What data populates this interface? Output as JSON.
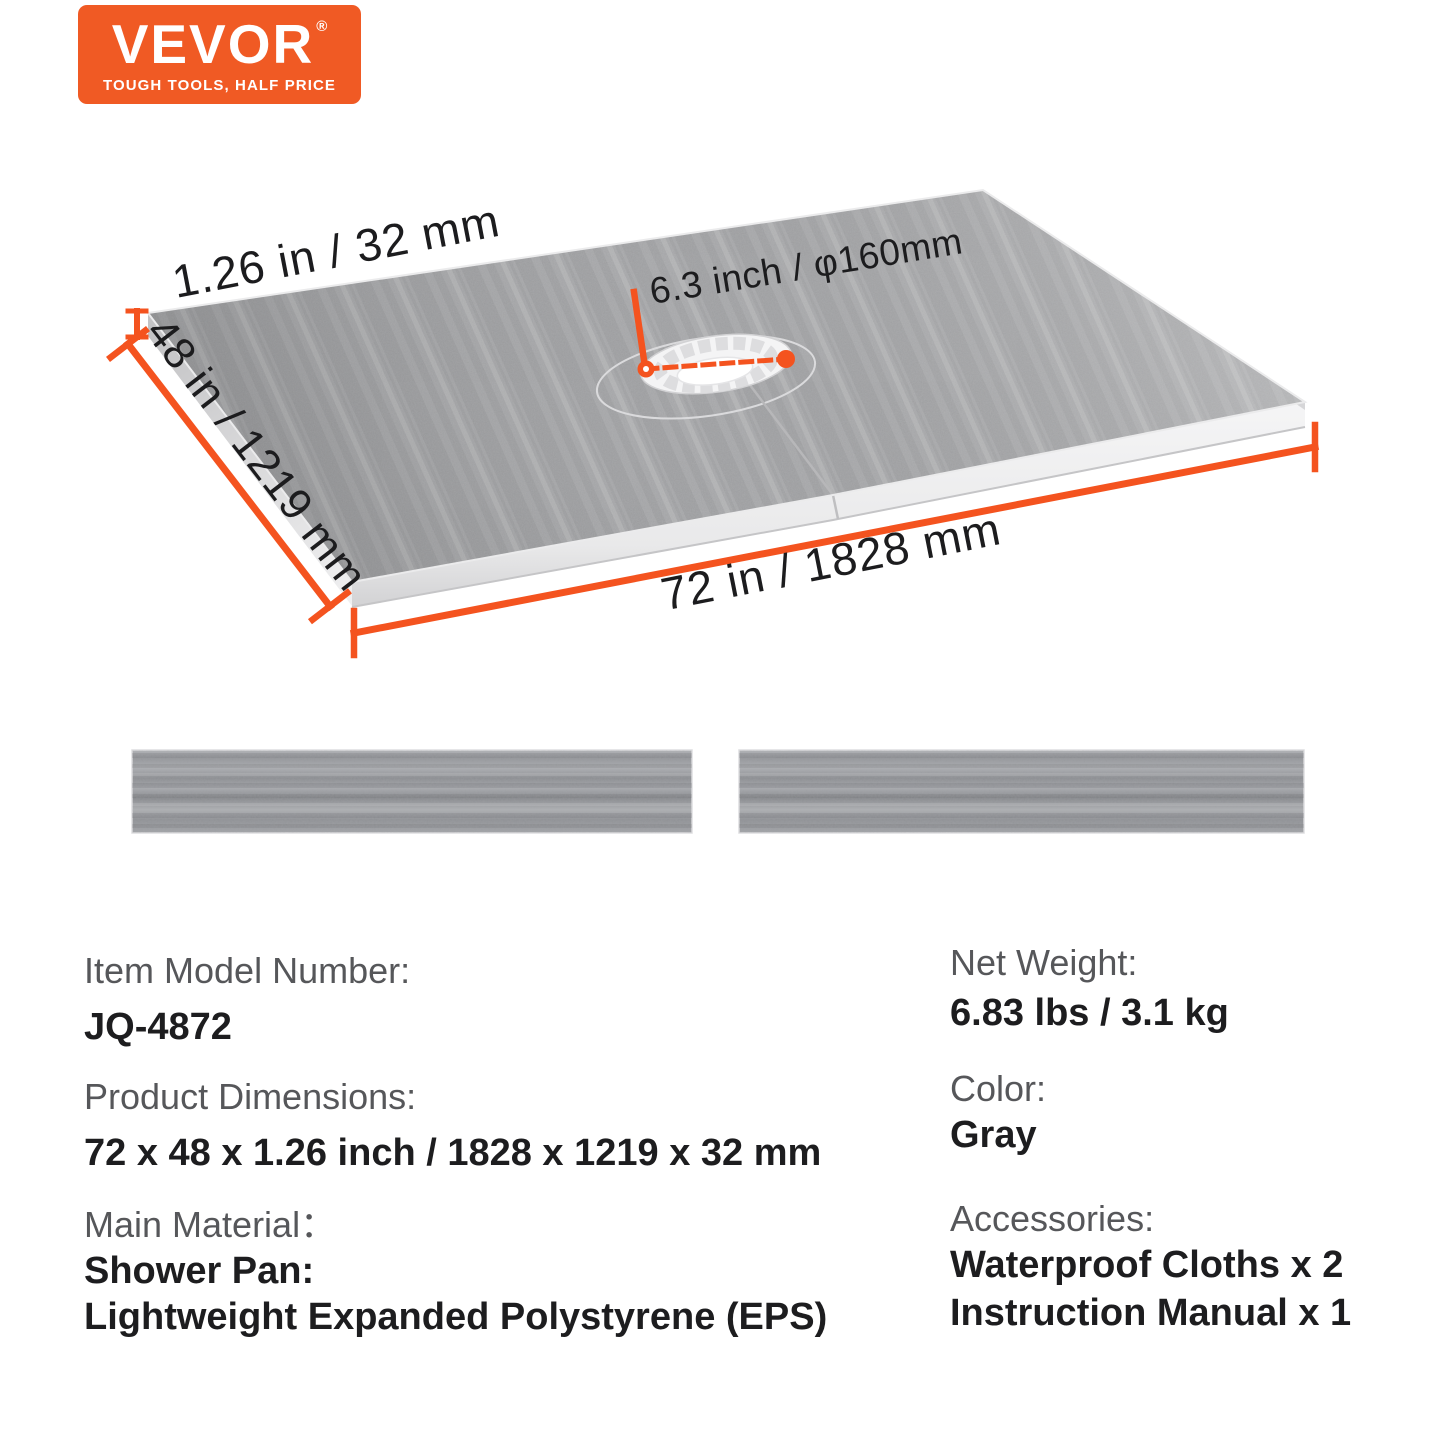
{
  "logo": {
    "brand": "VEVOR",
    "registered": "®",
    "tagline": "TOUGH TOOLS, HALF PRICE",
    "bg_color": "#F05A24"
  },
  "diagram": {
    "thickness_label": "1.26 in / 32 mm",
    "width_label": "48 in / 1219 mm",
    "length_label": "72 in / 1828 mm",
    "drain_label": "6.3 inch / φ160mm",
    "accent_color": "#F4531F",
    "pan_gray": "#a4a5a7"
  },
  "specs": {
    "left": [
      {
        "label": "Item Model Number:",
        "values": [
          "JQ-4872"
        ]
      },
      {
        "label": "Product Dimensions:",
        "values": [
          "72 x 48 x 1.26 inch / 1828 x 1219 x 32 mm"
        ]
      },
      {
        "label": "Main Material：",
        "values": [
          "Shower Pan:",
          "Lightweight Expanded Polystyrene (EPS)"
        ]
      }
    ],
    "right": [
      {
        "label": "Net Weight:",
        "values": [
          "6.83 lbs / 3.1 kg"
        ]
      },
      {
        "label": "Color:",
        "values": [
          "Gray"
        ]
      },
      {
        "label": "Accessories:",
        "values": [
          "Waterproof Cloths x 2",
          "Instruction Manual x 1"
        ]
      }
    ]
  }
}
